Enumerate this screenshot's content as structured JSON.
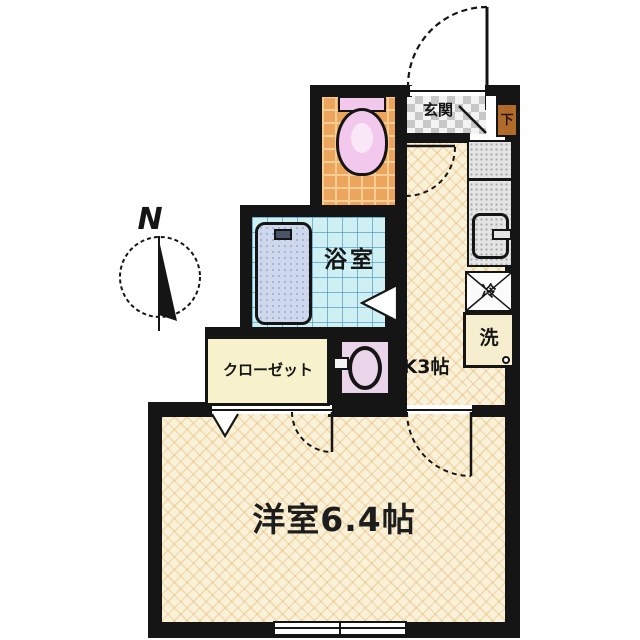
{
  "plan": {
    "compass_label": "N",
    "labels": {
      "entrance": "玄関",
      "shoe_cabinet": "下",
      "bathroom": "浴室",
      "closet": "クローゼット",
      "kitchen": "K3帖",
      "western_room": "洋室6.4帖",
      "refrigerator": "冷",
      "washer": "洗"
    },
    "colors": {
      "wall": "#151515",
      "floor_cream": "#faf2d8",
      "toilet_floor": "#eba55c",
      "bathroom_floor": "#cff0f2",
      "fixture_pink": "#f2c8ec",
      "washbasin_pink": "#ead4ea",
      "closet_fill": "#f8f2cc",
      "shoe_box_fill": "#b06a2a",
      "counter_gray": "#e4e4e4"
    }
  }
}
